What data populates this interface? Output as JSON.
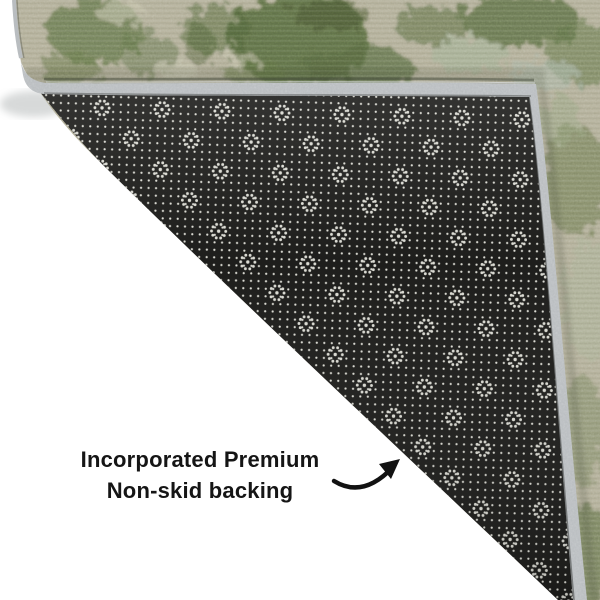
{
  "caption": {
    "line1": "Incorporated Premium",
    "line2": "Non-skid backing"
  },
  "subject": {
    "photo": "rug corner folded over revealing underside",
    "rug_pile": "mottled sage green and beige rug pile",
    "backing": "black non-skid backing with white dot and flower pattern",
    "binding": "light gray serged edge binding",
    "pointer": "curved arrow pointing toward backing"
  },
  "colors": {
    "background": "#ffffff",
    "rugBase": "#b3af99",
    "binding": "#b9bdc0",
    "backing": "#1d1d1b",
    "dot": "#dadad2",
    "text": "#151515",
    "arrow": "#121212"
  }
}
